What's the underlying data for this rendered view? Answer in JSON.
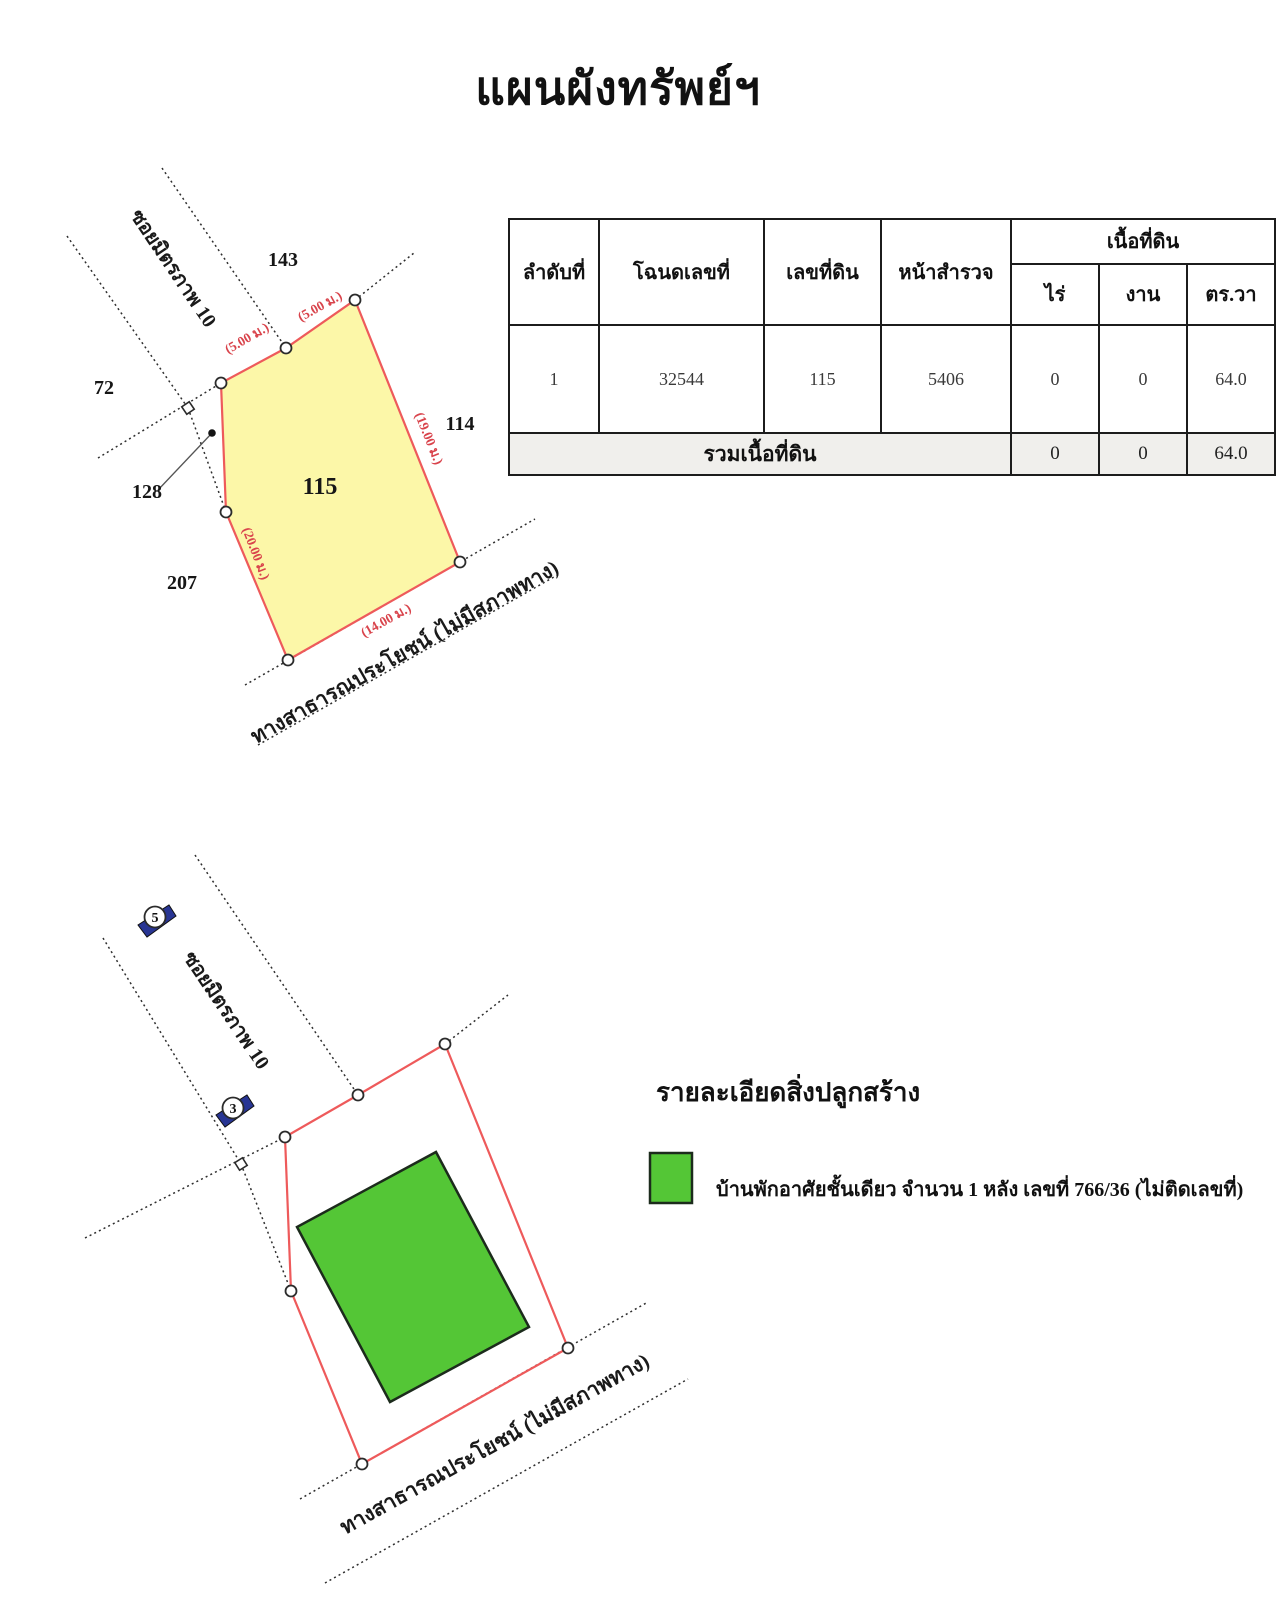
{
  "page": {
    "title": "แผนผังทรัพย์ฯ"
  },
  "table": {
    "headers": {
      "no": "ลำดับที่",
      "deed": "โฉนดเลขที่",
      "land_no": "เลขที่ดิน",
      "survey": "หน้าสำรวจ",
      "area": "เนื้อที่ดิน",
      "rai": "ไร่",
      "ngan": "งาน",
      "wah": "ตร.วา"
    },
    "rows": [
      {
        "no": "1",
        "deed": "32544",
        "land_no": "115",
        "survey": "5406",
        "rai": "0",
        "ngan": "0",
        "wah": "64.0"
      }
    ],
    "total": {
      "label": "รวมเนื้อที่ดิน",
      "rai": "0",
      "ngan": "0",
      "wah": "64.0"
    }
  },
  "plan1": {
    "parcel_no": "115",
    "neighbor_143": "143",
    "neighbor_72": "72",
    "neighbor_128": "128",
    "neighbor_207": "207",
    "neighbor_114": "114",
    "soi_label": "ซอยมิตรภาพ 10",
    "road_label": "ทางสาธารณประโยชน์ (ไม่มีสภาพทาง)",
    "dim_top_left": "(5.00 ม.)",
    "dim_top_right": "(5.00 ม.)",
    "dim_right": "(19.00 ม.)",
    "dim_left": "(20.00 ม.)",
    "dim_bottom": "(14.00 ม.)",
    "colors": {
      "parcel_fill": "#fcf7a8",
      "parcel_stroke": "#ee5a5b",
      "dim_text": "#d9444c"
    }
  },
  "plan2": {
    "soi_label": "ซอยมิตรภาพ 10",
    "road_label": "ทางสาธารณประโยชน์ (ไม่มีสภาพทาง)",
    "marker_5": "5",
    "marker_3": "3",
    "colors": {
      "boundary_stroke": "#ee5a5b",
      "building_fill": "#54c636"
    }
  },
  "legend": {
    "title": "รายละเอียดสิ่งปลูกสร้าง",
    "item": "บ้านพักอาศัยชั้นเดียว จำนวน 1 หลัง เลขที่ 766/36 (ไม่ติดเลขที่)",
    "swatch_color": "#54c636"
  }
}
